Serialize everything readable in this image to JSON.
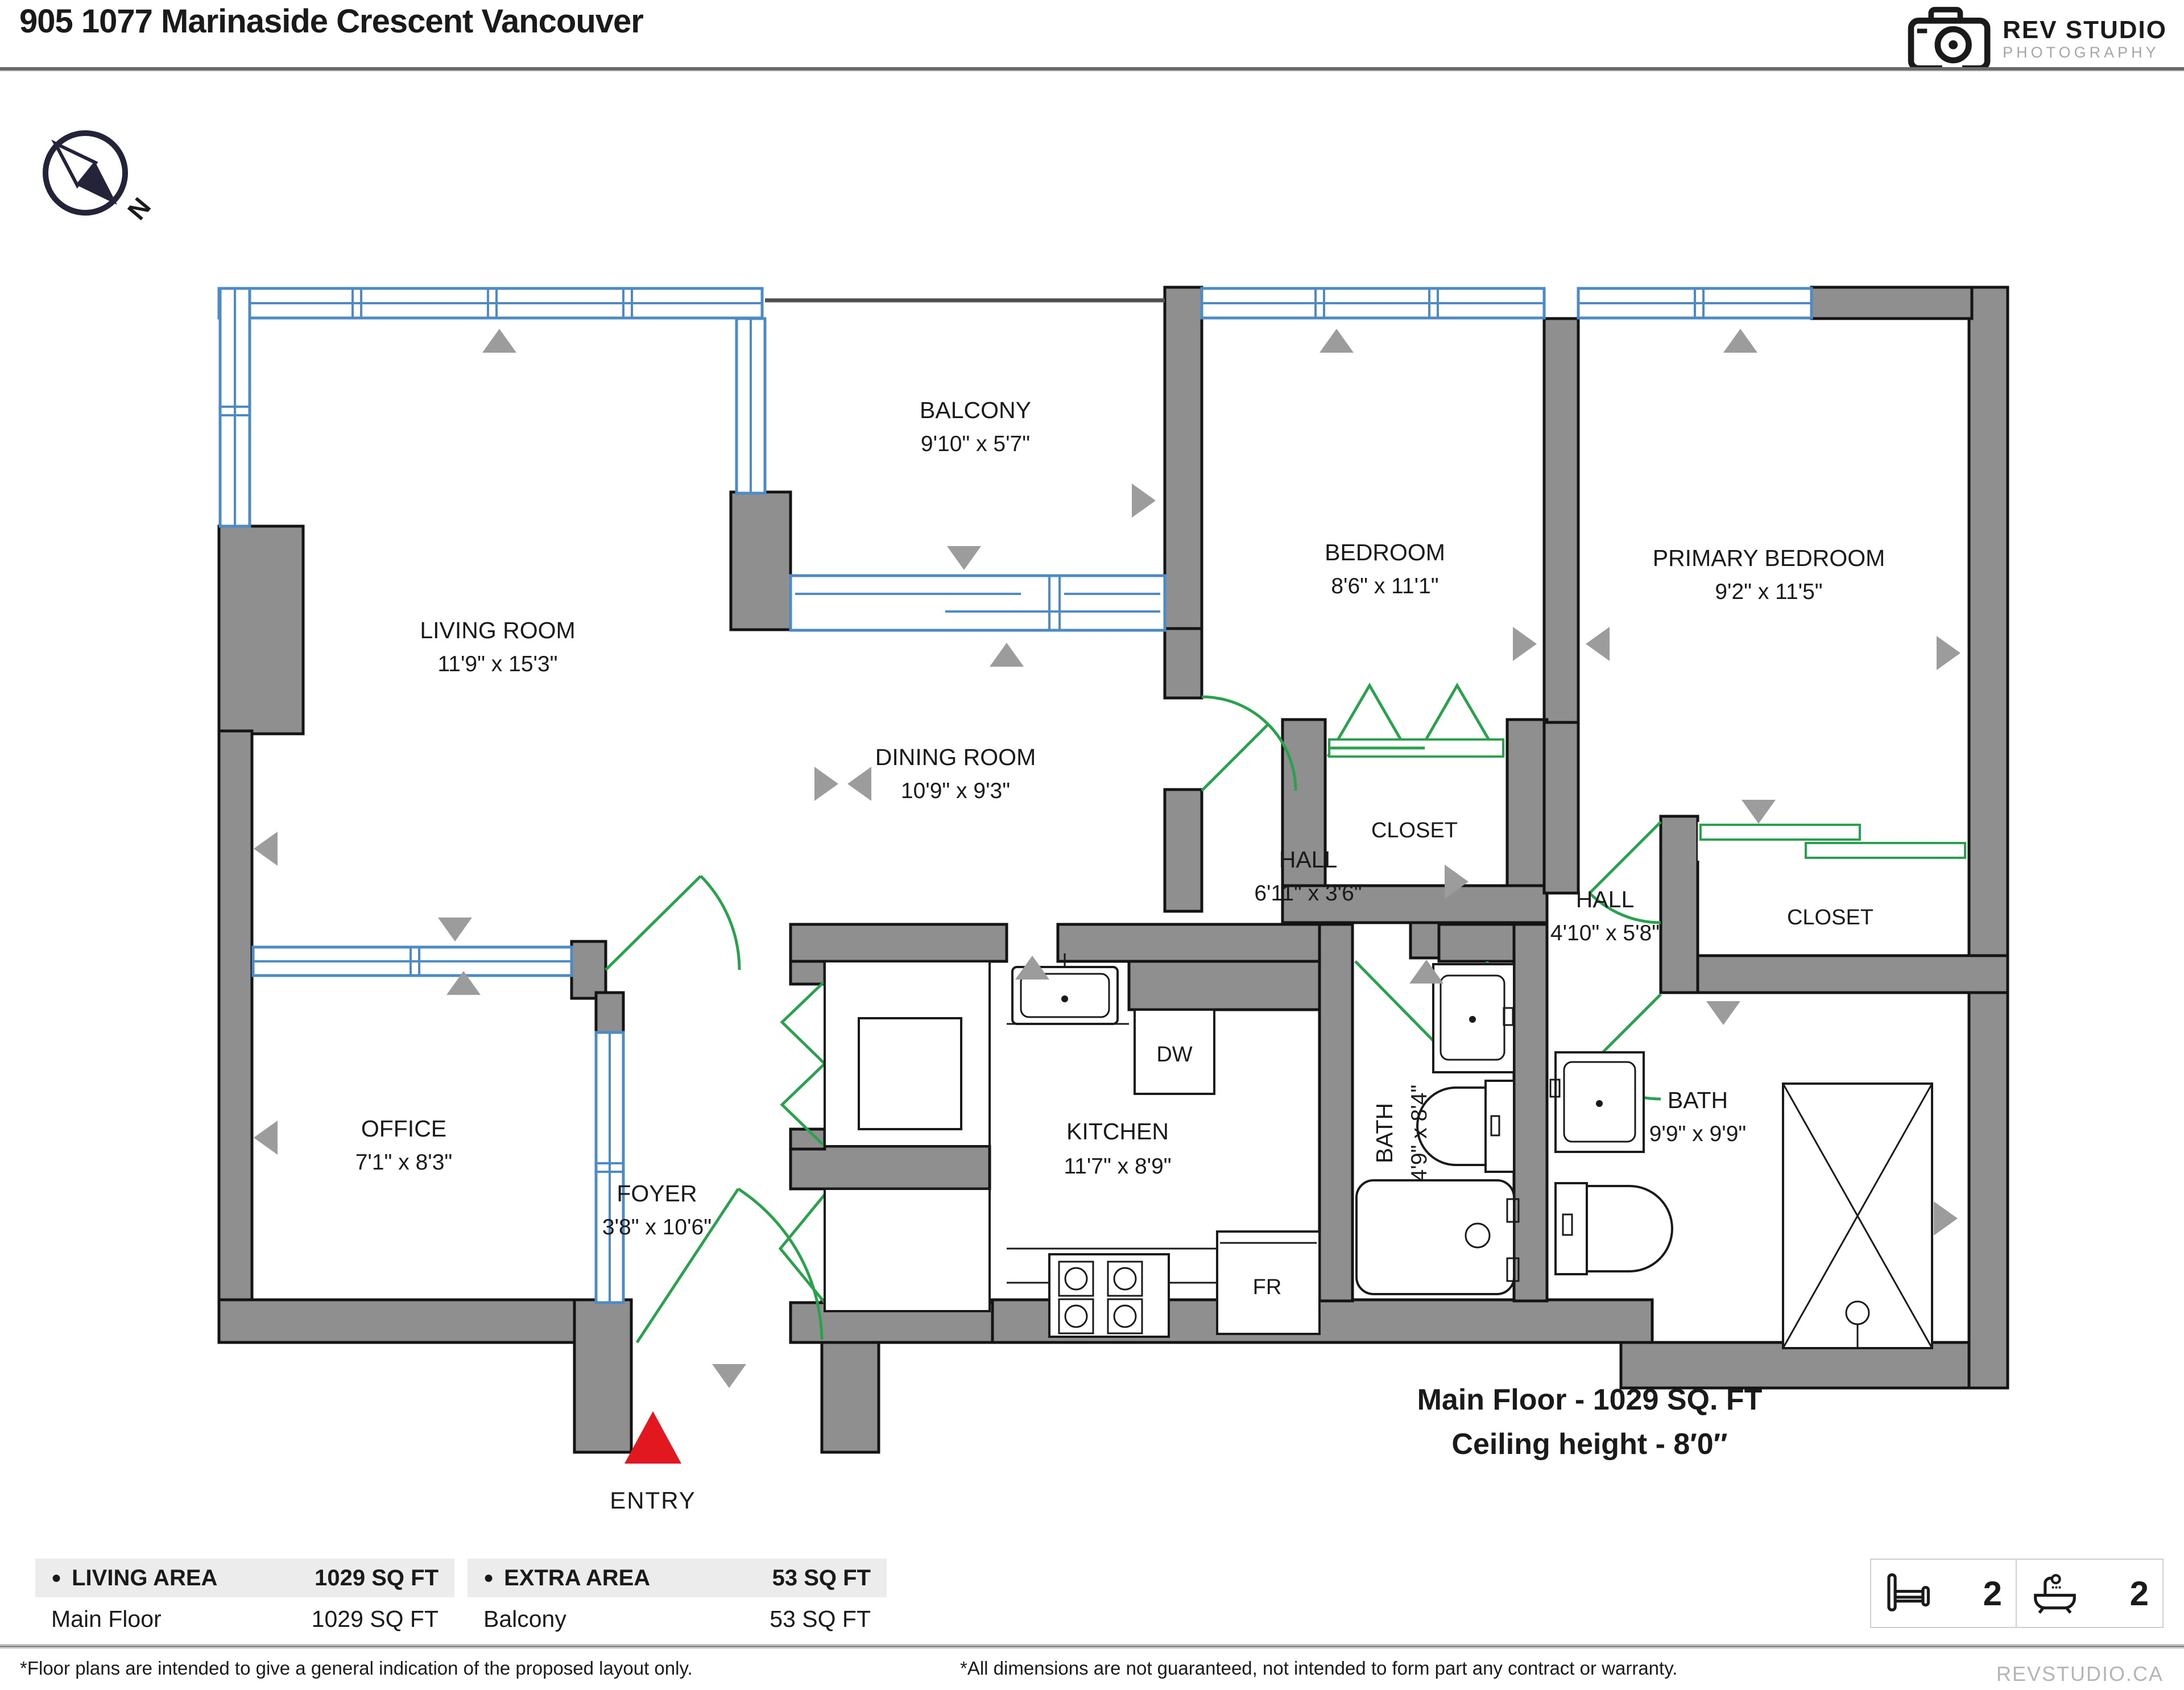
{
  "colors": {
    "wall": "#8f8f8f",
    "window": "#4e8bc4",
    "door": "#2aa14d",
    "entry": "#e1181f",
    "marker": "#9c9c9c",
    "accent_dark": "#23233a"
  },
  "header": {
    "title": "905 1077 Marinaside Crescent Vancouver",
    "logo_title": "REV STUDIO",
    "logo_subtitle": "PHOTOGRAPHY"
  },
  "compass": {
    "north_label": "N"
  },
  "rooms": {
    "living": {
      "name": "LIVING ROOM",
      "dims": "11'9\" x 15'3\""
    },
    "dining": {
      "name": "DINING ROOM",
      "dims": "10'9\" x 9'3\""
    },
    "balcony": {
      "name": "BALCONY",
      "dims": "9'10\" x 5'7\""
    },
    "bedroom": {
      "name": "BEDROOM",
      "dims": "8'6\" x 11'1\""
    },
    "primary": {
      "name": "PRIMARY BEDROOM",
      "dims": "9'2\" x 11'5\""
    },
    "office": {
      "name": "OFFICE",
      "dims": "7'1\" x 8'3\""
    },
    "foyer": {
      "name": "FOYER",
      "dims": "3'8\" x 10'6\""
    },
    "kitchen": {
      "name": "KITCHEN",
      "dims": "11'7\" x 8'9\""
    },
    "hall1": {
      "name": "HALL",
      "dims": "6'11\" x 3'6\""
    },
    "hall2": {
      "name": "HALL",
      "dims": "4'10\" x 5'8\""
    },
    "bath1": {
      "name": "BATH",
      "dims": "4'9\" x 8'4\""
    },
    "bath2": {
      "name": "BATH",
      "dims": "9'9\" x 9'9\""
    },
    "closet_bedroom": {
      "name": "CLOSET"
    },
    "closet_primary": {
      "name": "CLOSET"
    }
  },
  "appliances": {
    "washer_dryer": "W/D",
    "closet_small": "CL",
    "dishwasher": "DW",
    "fridge": "FR"
  },
  "entry": {
    "label": "ENTRY"
  },
  "summary": {
    "area_line": "Main Floor - 1029 SQ. FT",
    "ceiling_line": "Ceiling height - 8′0″"
  },
  "tables": {
    "living": {
      "header": "LIVING AREA",
      "header_value": "1029 SQ FT",
      "rows": [
        {
          "label": "Main Floor",
          "value": "1029 SQ FT"
        }
      ]
    },
    "extra": {
      "header": "EXTRA AREA",
      "header_value": "53 SQ FT",
      "rows": [
        {
          "label": "Balcony",
          "value": "53 SQ FT"
        }
      ]
    }
  },
  "stats": {
    "beds": "2",
    "baths": "2"
  },
  "footer": {
    "disclaimer_layout": "*Floor plans are intended to give a general indication of the proposed layout only.",
    "disclaimer_dims": "*All dimensions are not guaranteed, not intended to form part any contract or warranty.",
    "website": "REVSTUDIO.CA"
  }
}
